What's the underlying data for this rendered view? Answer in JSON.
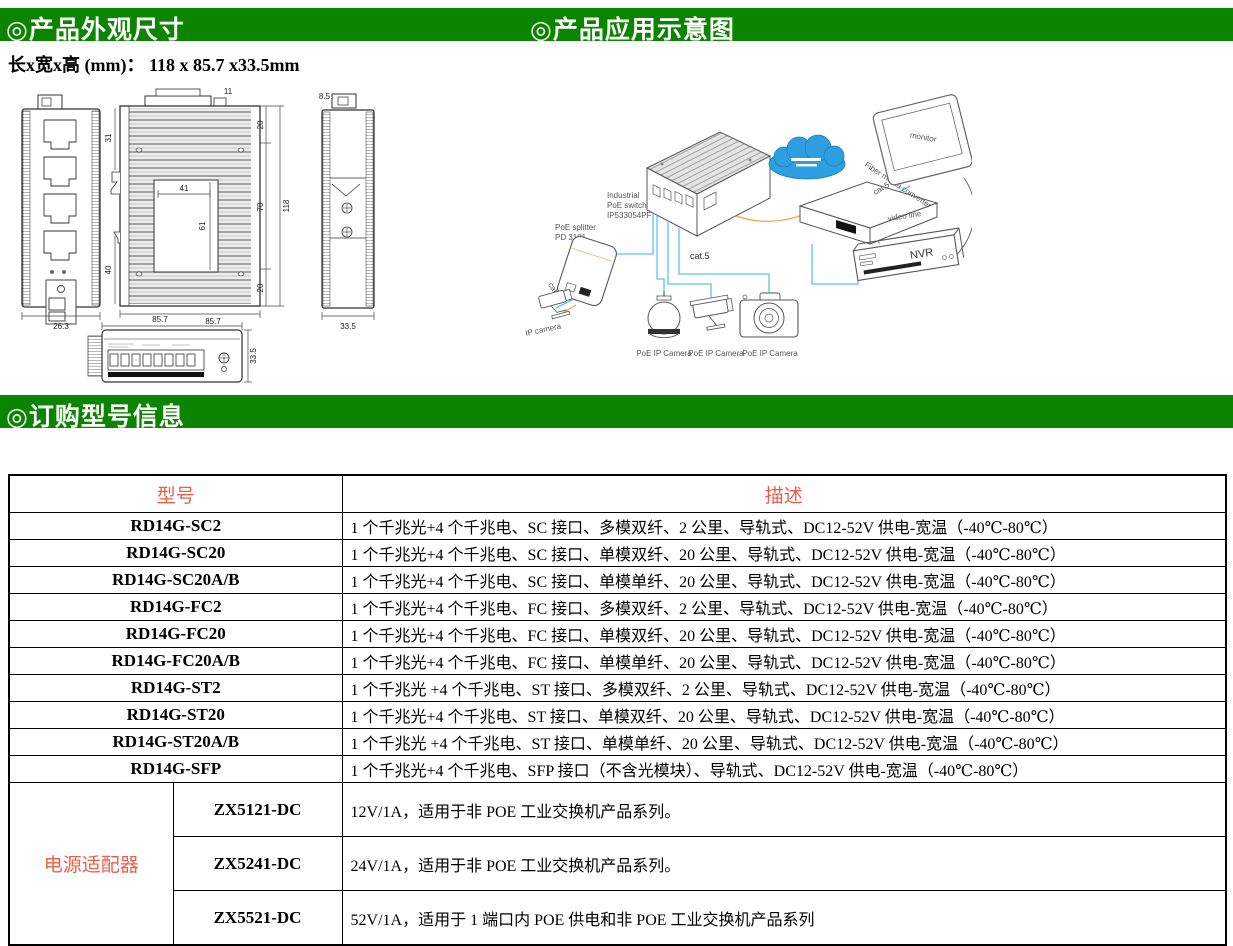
{
  "colors": {
    "header_green": "#0b8500",
    "table_red": "#e8604a",
    "line_blue": "#5ec3e8",
    "line_orange": "#f2a654",
    "cloud_blue": "#2d9fe0"
  },
  "header": {
    "left_title": "◎产品外观尺寸",
    "right_title": "◎产品应用示意图",
    "dimensions_line": "长x宽x高 (mm)： 118 x 85.7 x33.5mm",
    "order_title": "◎订购型号信息"
  },
  "drawing": {
    "front_width": "26.3",
    "rear_tab": "11",
    "rear_label_width": "41",
    "rear_label_height": "61",
    "rear_left_upper": "31",
    "rear_left_lower": "40",
    "rear_right_upper": "20",
    "rear_right_mid": "70",
    "rear_right_lower": "20",
    "rear_total_height": "118",
    "rear_width": "85.7",
    "side_top": "8.5",
    "side_width": "33.5",
    "bottom_width": "85.7",
    "bottom_depth": "33.5"
  },
  "diagram": {
    "switch_label_1": "Industrial",
    "switch_label_2": "PoE switch",
    "switch_label_3": "IP533054PF",
    "splitter_label_1": "PoE splitter",
    "splitter_label_2": "PD 3101",
    "ip_camera_label": "IP camera",
    "cat5_splitter": "cat.5",
    "cat5_center": "cat.5",
    "cat5_nvr": "cat.5",
    "fiber_converter_label": "Fiber media converter",
    "video_line_label": "video line",
    "nvr_label": "NVR",
    "monitor_label": "monitor",
    "poe_camera_label_1": "PoE IP Camera",
    "poe_camera_label_2": "PoE IP Camera",
    "poe_camera_label_3": "PoE IP Camera"
  },
  "table": {
    "headers": [
      "型号",
      "描述"
    ],
    "rows": [
      {
        "model": "RD14G-SC2",
        "desc": "1 个千兆光+4 个千兆电、SC 接口、多模双纤、2 公里、导轨式、DC12-52V 供电-宽温（-40℃-80℃）"
      },
      {
        "model": "RD14G-SC20",
        "desc": "1 个千兆光+4 个千兆电、SC 接口、单模双纤、20 公里、导轨式、DC12-52V 供电-宽温（-40℃-80℃）"
      },
      {
        "model": "RD14G-SC20A/B",
        "desc": "1 个千兆光+4 个千兆电、SC 接口、单模单纤、20 公里、导轨式、DC12-52V 供电-宽温（-40℃-80℃）"
      },
      {
        "model": "RD14G-FC2",
        "desc": "1 个千兆光+4 个千兆电、FC 接口、多模双纤、2 公里、导轨式、DC12-52V 供电-宽温（-40℃-80℃）"
      },
      {
        "model": "RD14G-FC20",
        "desc": "1 个千兆光+4 个千兆电、FC 接口、单模双纤、20 公里、导轨式、DC12-52V 供电-宽温（-40℃-80℃）"
      },
      {
        "model": "RD14G-FC20A/B",
        "desc": "1 个千兆光+4 个千兆电、FC 接口、单模单纤、20 公里、导轨式、DC12-52V 供电-宽温（-40℃-80℃）"
      },
      {
        "model": "RD14G-ST2",
        "desc": "1 个千兆光 +4 个千兆电、ST 接口、多模双纤、2 公里、导轨式、DC12-52V 供电-宽温（-40℃-80℃）"
      },
      {
        "model": "RD14G-ST20",
        "desc": "1 个千兆光+4 个千兆电、ST 接口、单模双纤、20 公里、导轨式、DC12-52V 供电-宽温（-40℃-80℃）"
      },
      {
        "model": "RD14G-ST20A/B",
        "desc": "1 个千兆光 +4 个千兆电、ST 接口、单模单纤、20 公里、导轨式、DC12-52V 供电-宽温（-40℃-80℃）"
      },
      {
        "model": "RD14G-SFP",
        "desc": "1 个千兆光+4 个千兆电、SFP 接口（不含光模块）、导轨式、DC12-52V 供电-宽温（-40℃-80℃）"
      }
    ],
    "adapter": {
      "label": "电源适配器",
      "rows": [
        {
          "model": "ZX5121-DC",
          "desc": "12V/1A，适用于非 POE 工业交换机产品系列。"
        },
        {
          "model": "ZX5241-DC",
          "desc": "24V/1A，适用于非 POE 工业交换机产品系列。"
        },
        {
          "model": "ZX5521-DC",
          "desc": "52V/1A，适用于 1 端口内 POE 供电和非 POE 工业交换机产品系列"
        }
      ]
    }
  }
}
